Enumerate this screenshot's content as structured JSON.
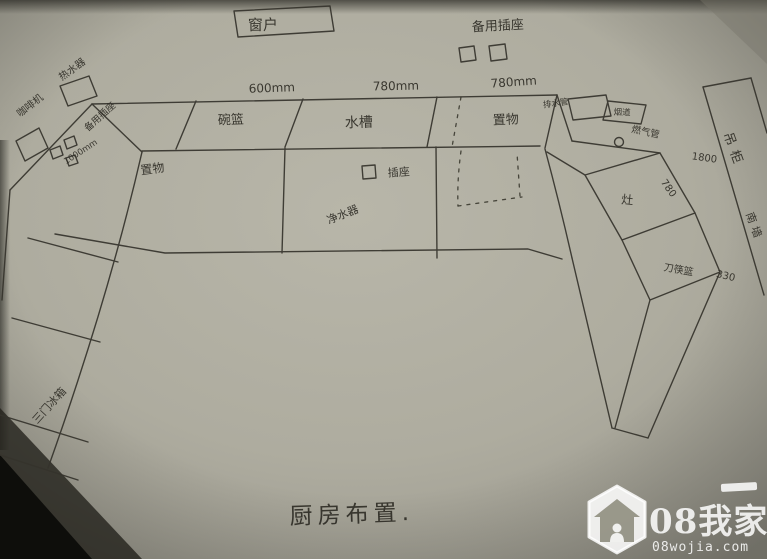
{
  "title": "厨房布置.",
  "window": {
    "label": "窗户"
  },
  "outlets": {
    "top_label": "备用插座",
    "left_label": "备用插座",
    "counter_label": "插座"
  },
  "dimensions": {
    "top": [
      "600mm",
      "780mm",
      "780mm"
    ],
    "left": "1000mm",
    "right_edge": "780",
    "hanging": "1800",
    "knife": "330"
  },
  "back_counter": {
    "sections": [
      "碗篮",
      "水槽",
      "置物"
    ]
  },
  "left_counter": {
    "storage": "置物"
  },
  "appliances": {
    "water_heater": "热水器",
    "coffee_machine": "咖啡机",
    "water_purifier": "净水器",
    "fridge": "三门冰箱",
    "stove": "灶",
    "knife_basket": "刀筷篮"
  },
  "right_side": {
    "drain_pipe": "排水管",
    "flue": "烟道",
    "gas_pipe": "燃气管",
    "hanging_cabinet": "吊柜",
    "wall_note": "南墙"
  },
  "watermark": {
    "brand": "08我家",
    "site": "08wojia.com"
  },
  "colors": {
    "paper": "#b2b0a3",
    "ink": "#35332c",
    "watermark": "#ffffff"
  }
}
